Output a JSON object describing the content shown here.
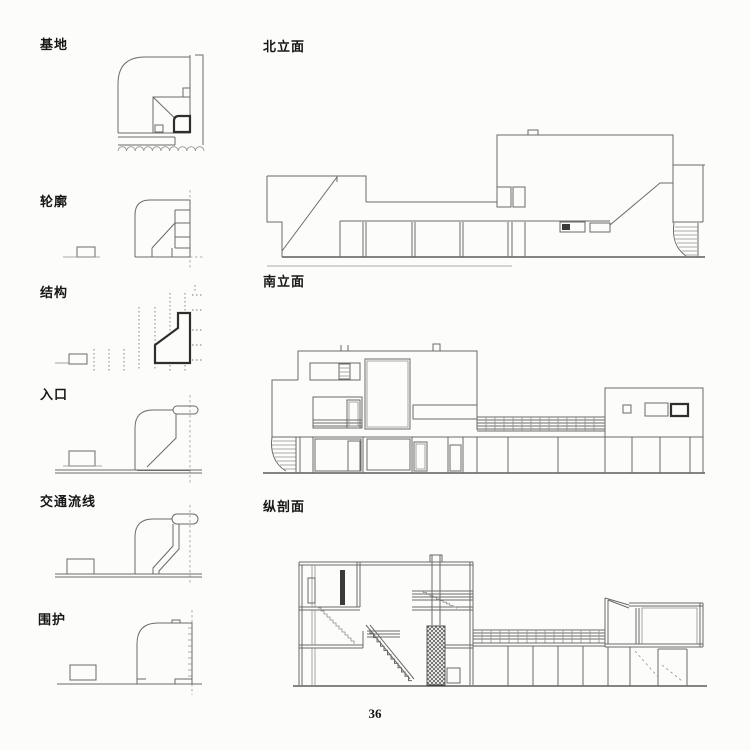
{
  "page": {
    "number": "36"
  },
  "analysis_column": {
    "items": [
      {
        "id": "site",
        "label": "基地"
      },
      {
        "id": "outline",
        "label": "轮廓"
      },
      {
        "id": "structure",
        "label": "结构"
      },
      {
        "id": "entrance",
        "label": "入口"
      },
      {
        "id": "circulation",
        "label": "交通流线"
      },
      {
        "id": "enclosure",
        "label": "围护"
      }
    ]
  },
  "drawings_column": {
    "sections": [
      {
        "id": "north-elevation",
        "label": "北立面"
      },
      {
        "id": "south-elevation",
        "label": "南立面"
      },
      {
        "id": "longitudinal-section",
        "label": "纵剖面"
      }
    ]
  },
  "colors": {
    "background": "#fcfcfa",
    "line": "#6a6a6a",
    "bold_line": "#2e2e2e",
    "text": "#111111"
  }
}
